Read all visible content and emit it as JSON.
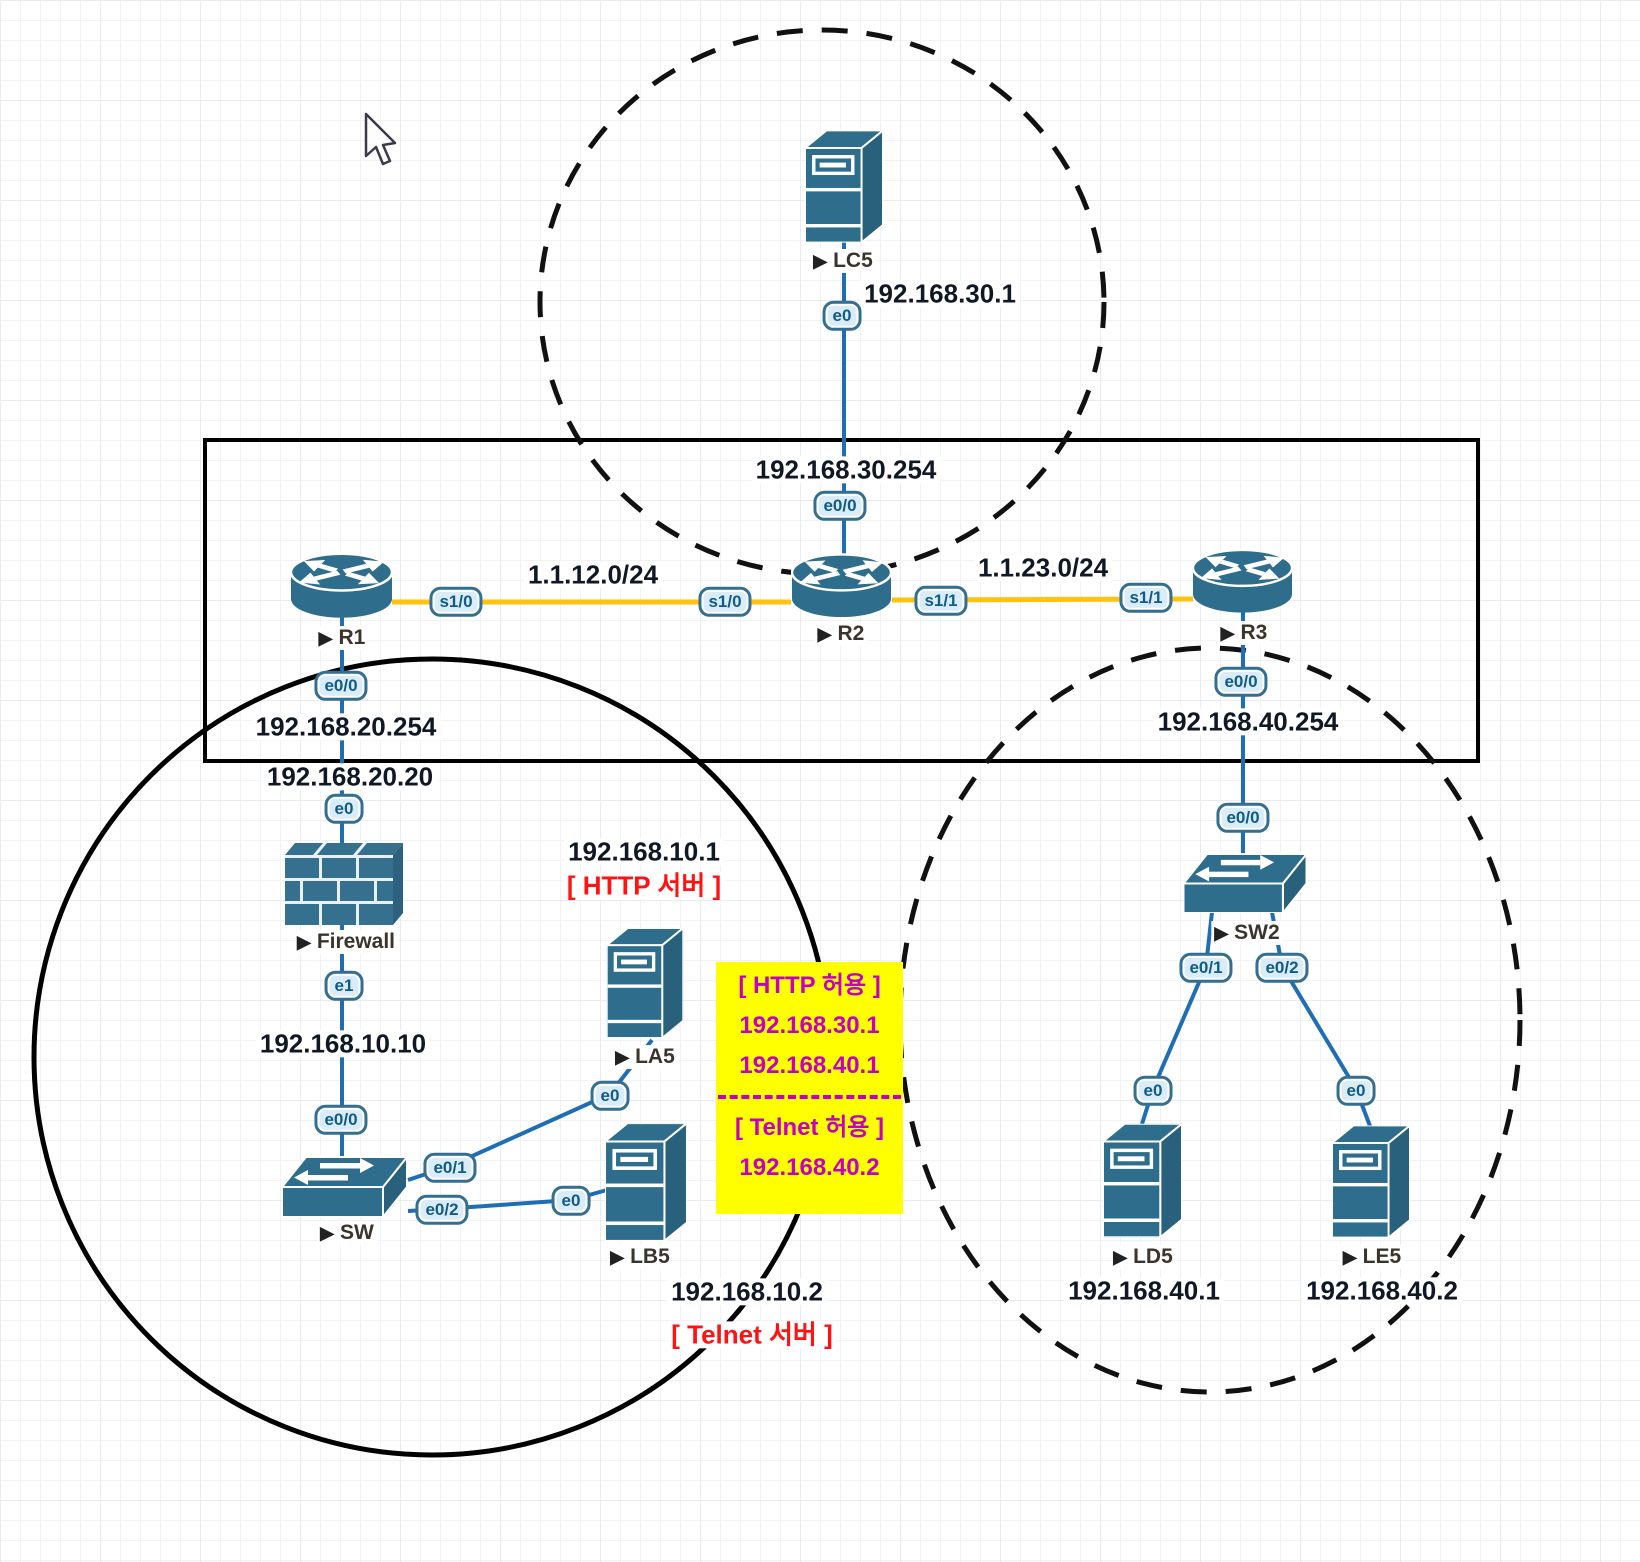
{
  "ui": {
    "device_marker": "▶"
  },
  "devices": {
    "lc5": {
      "label": "LC5",
      "type": "server"
    },
    "r1": {
      "label": "R1",
      "type": "router"
    },
    "r2": {
      "label": "R2",
      "type": "router"
    },
    "r3": {
      "label": "R3",
      "type": "router"
    },
    "firewall": {
      "label": "Firewall",
      "type": "firewall"
    },
    "sw": {
      "label": "SW",
      "type": "switch"
    },
    "sw2": {
      "label": "SW2",
      "type": "switch"
    },
    "la5": {
      "label": "LA5",
      "type": "server"
    },
    "lb5": {
      "label": "LB5",
      "type": "server"
    },
    "ld5": {
      "label": "LD5",
      "type": "server"
    },
    "le5": {
      "label": "LE5",
      "type": "server"
    }
  },
  "ports": {
    "lc5_e0": "e0",
    "r2_e00": "e0/0",
    "r1_s10": "s1/0",
    "r2_s10": "s1/0",
    "r2_s11": "s1/1",
    "r3_s11": "s1/1",
    "r1_e00": "e0/0",
    "fw_e0": "e0",
    "fw_e1": "e1",
    "sw_e00": "e0/0",
    "sw_e01": "e0/1",
    "sw_e02": "e0/2",
    "la5_e0": "e0",
    "lb5_e0": "e0",
    "r3_e00": "e0/0",
    "sw2_e00": "e0/0",
    "sw2_e01": "e0/1",
    "sw2_e02": "e0/2",
    "ld5_e0": "e0",
    "le5_e0": "e0"
  },
  "addresses": {
    "lc5_ip": "192.168.30.1",
    "r2_e00_ip": "192.168.30.254",
    "net_r1_r2": "1.1.12.0/24",
    "net_r2_r3": "1.1.23.0/24",
    "r1_e00_ip": "192.168.20.254",
    "fw_e0_ip": "192.168.20.20",
    "fw_e1_ip": "192.168.10.10",
    "la5_ip": "192.168.10.1",
    "lb5_ip": "192.168.10.2",
    "r3_e00_ip": "192.168.40.254",
    "ld5_ip": "192.168.40.1",
    "le5_ip": "192.168.40.2"
  },
  "annotations": {
    "la5_role": "[ HTTP 서버 ]",
    "lb5_role": "[ Telnet 서버 ]"
  },
  "acl_note": {
    "http_title": "[ HTTP 허용 ]",
    "http_allowed": [
      "192.168.30.1",
      "192.168.40.1"
    ],
    "telnet_title": "[ Telnet 허용 ]",
    "telnet_allowed": [
      "192.168.40.2"
    ]
  },
  "colors": {
    "device_fill": "#2e6d8c",
    "device_side": "#29617c",
    "serial_link": "#ffc20e",
    "ethernet_link": "#1f6db5",
    "note_bg": "#ffff00",
    "note_text": "#c400c4",
    "role_text": "#ff1212",
    "ip_label_text": "#101826",
    "port_fill": "#d9ecf8",
    "port_border": "#346e90",
    "zone_stroke": "#000000"
  }
}
